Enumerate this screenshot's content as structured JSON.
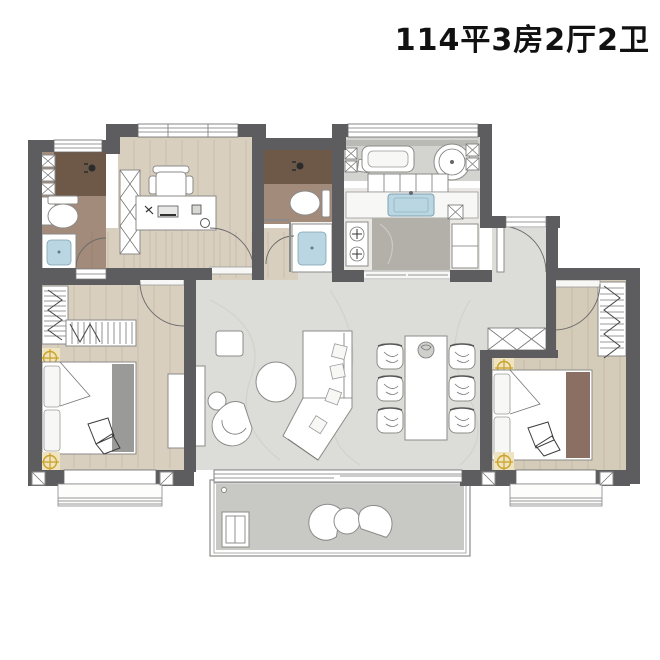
{
  "title": "114平3房2厅2卫",
  "palette": {
    "wall": "#5d5d5f",
    "wood_floor": "#d9cfbf",
    "wood_floor_dark": "#cfc4b1",
    "marble_floor": "#dcdcd8",
    "kitchen_floor": "#e9e8e4",
    "bath_floor": "#a28b7a",
    "shower_floor": "#6e5949",
    "utility_floor": "#d3d4d0",
    "balcony_floor": "#c8c8c4",
    "island_gray": "#b3b0aa",
    "sink_blue": "#b9d6e2",
    "accent_yellow": "#c9a227",
    "bed_runner_gray": "#9a9a98",
    "bed_runner_brown": "#8a6f62"
  },
  "rooms": [
    {
      "name": "bathroom-1"
    },
    {
      "name": "study"
    },
    {
      "name": "bathroom-2"
    },
    {
      "name": "laundry-balcony"
    },
    {
      "name": "kitchen"
    },
    {
      "name": "entry"
    },
    {
      "name": "living-dining"
    },
    {
      "name": "bedroom-left"
    },
    {
      "name": "master-bedroom"
    },
    {
      "name": "balcony"
    }
  ]
}
